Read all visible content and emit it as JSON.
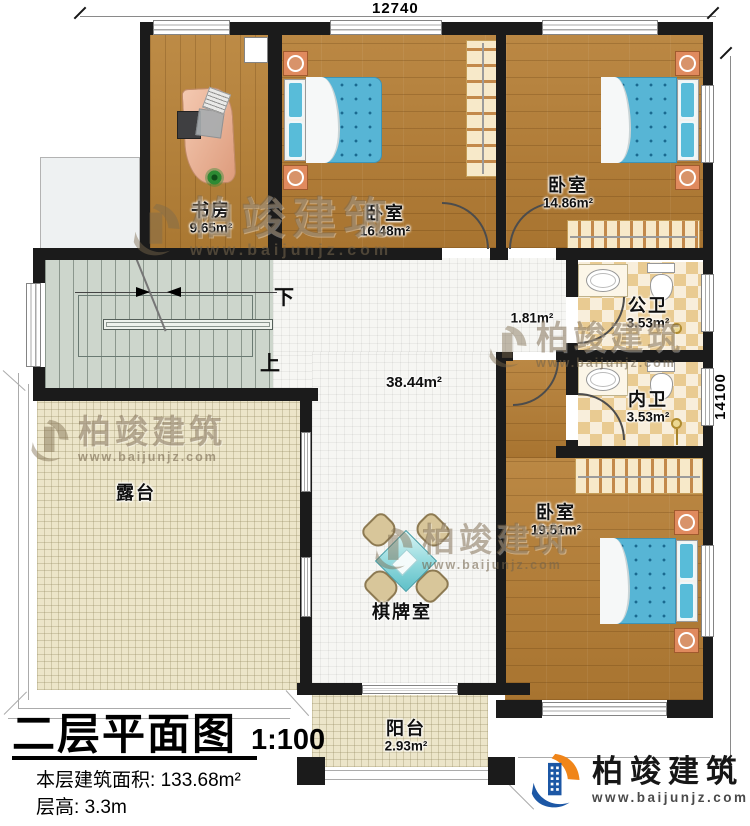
{
  "dimensions": {
    "top": "12740",
    "right": "14100"
  },
  "rooms": {
    "study": {
      "name": "书房",
      "area": "9.65m²"
    },
    "bedroom1": {
      "name": "卧室",
      "area": "16.48m²"
    },
    "bedroom2": {
      "name": "卧室",
      "area": "14.86m²"
    },
    "public_bath": {
      "name": "公卫",
      "area": "3.53m²"
    },
    "private_bath": {
      "name": "内卫",
      "area": "3.53m²"
    },
    "bedroom3": {
      "name": "卧室",
      "area": "19.51m²"
    },
    "hall": {
      "area": "38.44m²"
    },
    "corridor": {
      "area": "1.81m²"
    },
    "terrace": {
      "name": "露台"
    },
    "game_room": {
      "name": "棋牌室"
    },
    "balcony": {
      "name": "阳台",
      "area": "2.93m²"
    }
  },
  "stairs": {
    "down": "下",
    "up": "上"
  },
  "title_block": {
    "title": "二层平面图",
    "scale": "1:100",
    "area_label": "本层建筑面积:",
    "area_value": "133.68m²",
    "height_label": "层高:",
    "height_value": "3.3m"
  },
  "branding": {
    "name": "柏竣建筑",
    "url": "www.baijunjz.com"
  },
  "watermark": {
    "name": "柏竣建筑",
    "url": "www.baijunjz.com"
  },
  "colors": {
    "wall": "#1b1b1b",
    "wood_floor": "#b2803c",
    "white_tile": "#f6f6f3",
    "cream_tile": "#ece5c9",
    "stair_floor": "#cdd6cc",
    "bath_tile": "#e9cb92",
    "bed_blue": "#57b5d5",
    "logo_blue": "#1c57a5",
    "logo_orange": "#f08519"
  }
}
